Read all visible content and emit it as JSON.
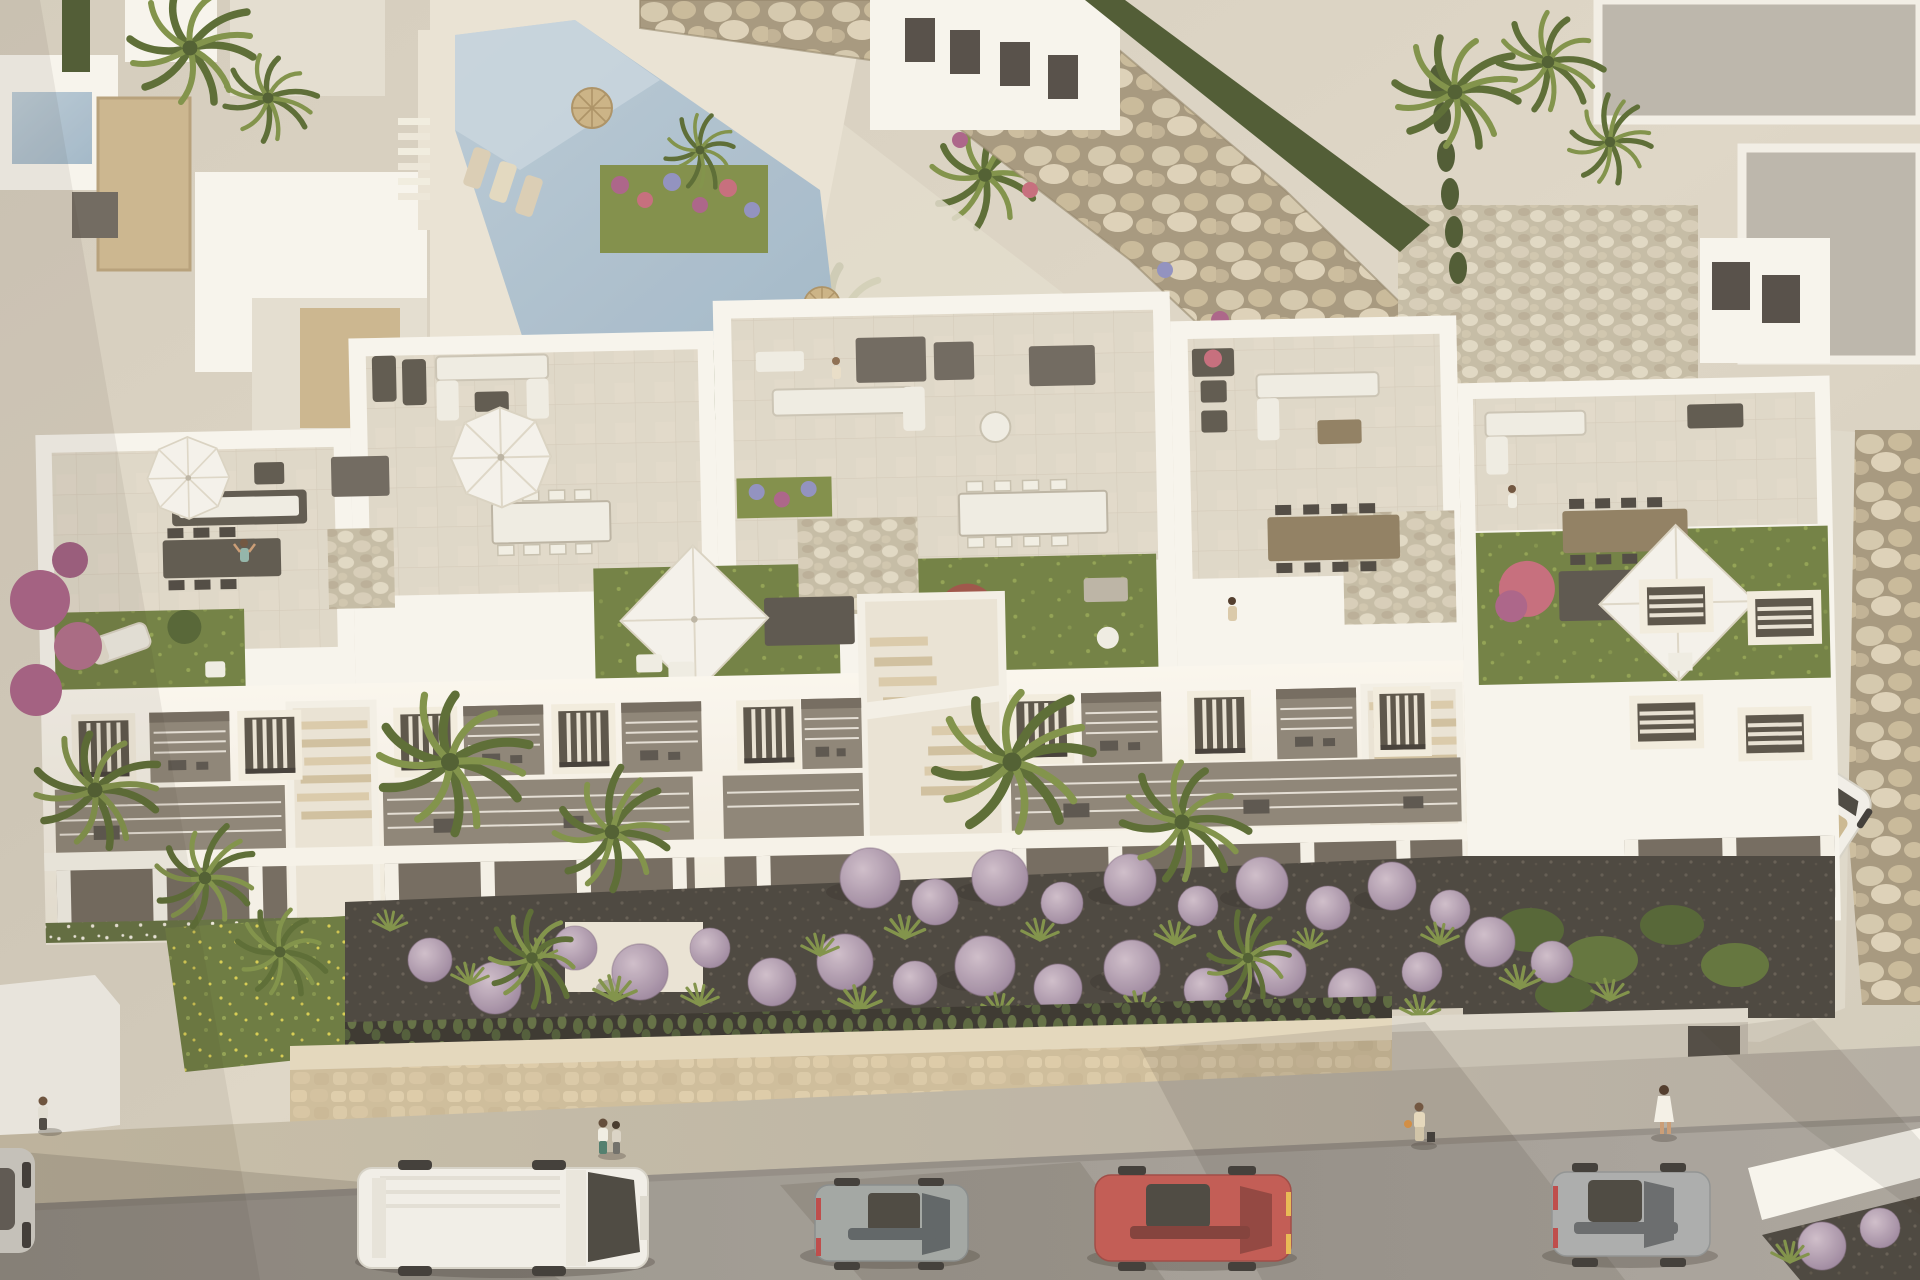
{
  "scene": {
    "type": "3d-architectural-render",
    "description": "Aerial rendering of a modern white Mediterranean apartment complex with furnished rooftop terraces and lawns, a communal pool with rock retaining wall, landscaped front gardens with round purple shrubs and palm trees, a beige stone boundary wall, and a street with parked cars and pedestrians in warm late-afternoon light",
    "view": "high angle aerial, looking slightly north",
    "lighting": "low sun from upper right casting long soft shadows to lower left"
  },
  "palette": {
    "groundBase": "#d8d1c3",
    "deck": "#e9e3d5",
    "wallWhite": "#f7f5ef",
    "wallSun": "#faf7f0",
    "wallShade": "#e3ddd1",
    "wallDark": "#cfc8ba",
    "tile": "#ded7c8",
    "tileLine": "#cdc5b4",
    "stone": "#c9b48d",
    "stoneWallLight": "#e3d7bd",
    "rockBg": "#a3957c",
    "pool": "#b9cad7",
    "poolDeep": "#9fb6c8",
    "lawn": "#6d7d3f",
    "lawnLight": "#8ea04f",
    "flowerYellow": "#d6cc4e",
    "hedge": "#49552e",
    "palm1": "#55682f",
    "palm2": "#7c8f45",
    "pampas": "#d9cdb2",
    "shrubPurple": "#bba6b5",
    "shrubPurpleDark": "#96809a",
    "flowerPink": "#c4697a",
    "flowerMagenta": "#a85f86",
    "flowerBlue": "#8d8ec0",
    "leafRed": "#9b4f44",
    "gravelDark": "#45403a",
    "gravelLight": "#cfc6b2",
    "road": "#9d9890",
    "sidewalk": "#bcb4a4",
    "shadow": "rgba(56,50,42,0.30)",
    "grayRoof": "#b9b4ab",
    "vanWhite": "#f1efe9",
    "carGrey": "#9fa4a2",
    "carRed": "#c0564f",
    "carGrey2": "#a8abac",
    "carGlass": "#46423c",
    "convertibleInterior": "#c9b68f",
    "furnDark": "#5a544b",
    "furnWhite": "#efece4",
    "woodTable": "#8d7c5f",
    "parasol": "#f4f2ec",
    "skinTan": "#c89a72"
  },
  "objects": {
    "main_building": "three-block white apartment complex with penthouse roof terraces",
    "roof_terrace_features": [
      "white octagonal parasols",
      "white square parasols",
      "outdoor sofas",
      "dining tables with chairs",
      "sun loungers",
      "artificial lawn patches",
      "pebble-roofed stair towers",
      "flower planters"
    ],
    "amenities": [
      "communal swimming pool",
      "pool deck with straw umbrellas and loungers",
      "rock boulder retaining wall",
      "landscaped gardens"
    ],
    "vegetation": [
      "fan palms",
      "round purple shrubs",
      "ornamental grasses",
      "cypress hedges",
      "bougainvillea",
      "pampas grass"
    ],
    "street": {
      "cars": [
        {
          "id": "partial-car-left-edge",
          "color_key": "carGrey2"
        },
        {
          "id": "white-panel-van",
          "color_key": "vanWhite"
        },
        {
          "id": "grey-hatchback",
          "color_key": "carGrey"
        },
        {
          "id": "red-hatchback",
          "color_key": "carRed"
        },
        {
          "id": "grey-car-right",
          "color_key": "carGrey2"
        },
        {
          "id": "white-convertible-in-driveway",
          "color_key": "vanWhite"
        }
      ],
      "pedestrian_count": 8
    },
    "neighbors": [
      "villas with beige stone accents upper left",
      "villas with grey flat roofs upper right"
    ]
  }
}
